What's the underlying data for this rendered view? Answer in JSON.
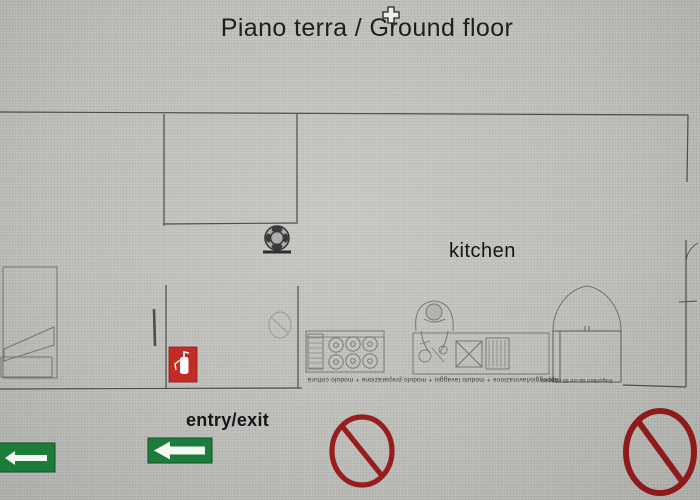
{
  "title": "Piano terra / Ground floor",
  "floor_plan": {
    "room_labels": {
      "kitchen": "kitchen"
    },
    "door_label": "entry/exit",
    "counter_caption": "appoggio/lavorazione + modulo lavaggio + modulo preparazione + modulo cottura",
    "fridge_caption": "Frigorifero da cm 90 (doppio)"
  },
  "icons": {
    "cursor": "move-cursor-icon",
    "boiler": "boiler-icon",
    "extinguisher": "fire-extinguisher-icon",
    "exit_arrow_left_edge": "exit-arrow-sign-icon",
    "exit_arrow_entry": "exit-arrow-sign-icon",
    "no_entry_center": "no-entry-icon",
    "no_entry_right": "no-entry-icon"
  },
  "colors": {
    "background": "#bdbeba",
    "wall_line": "#4d4d4d",
    "furniture_line": "#737373",
    "exit_green": "#1c7c3a",
    "extinguisher_red": "#c32b25",
    "prohibition_red": "#961e1e",
    "text": "#1e1e1e"
  }
}
